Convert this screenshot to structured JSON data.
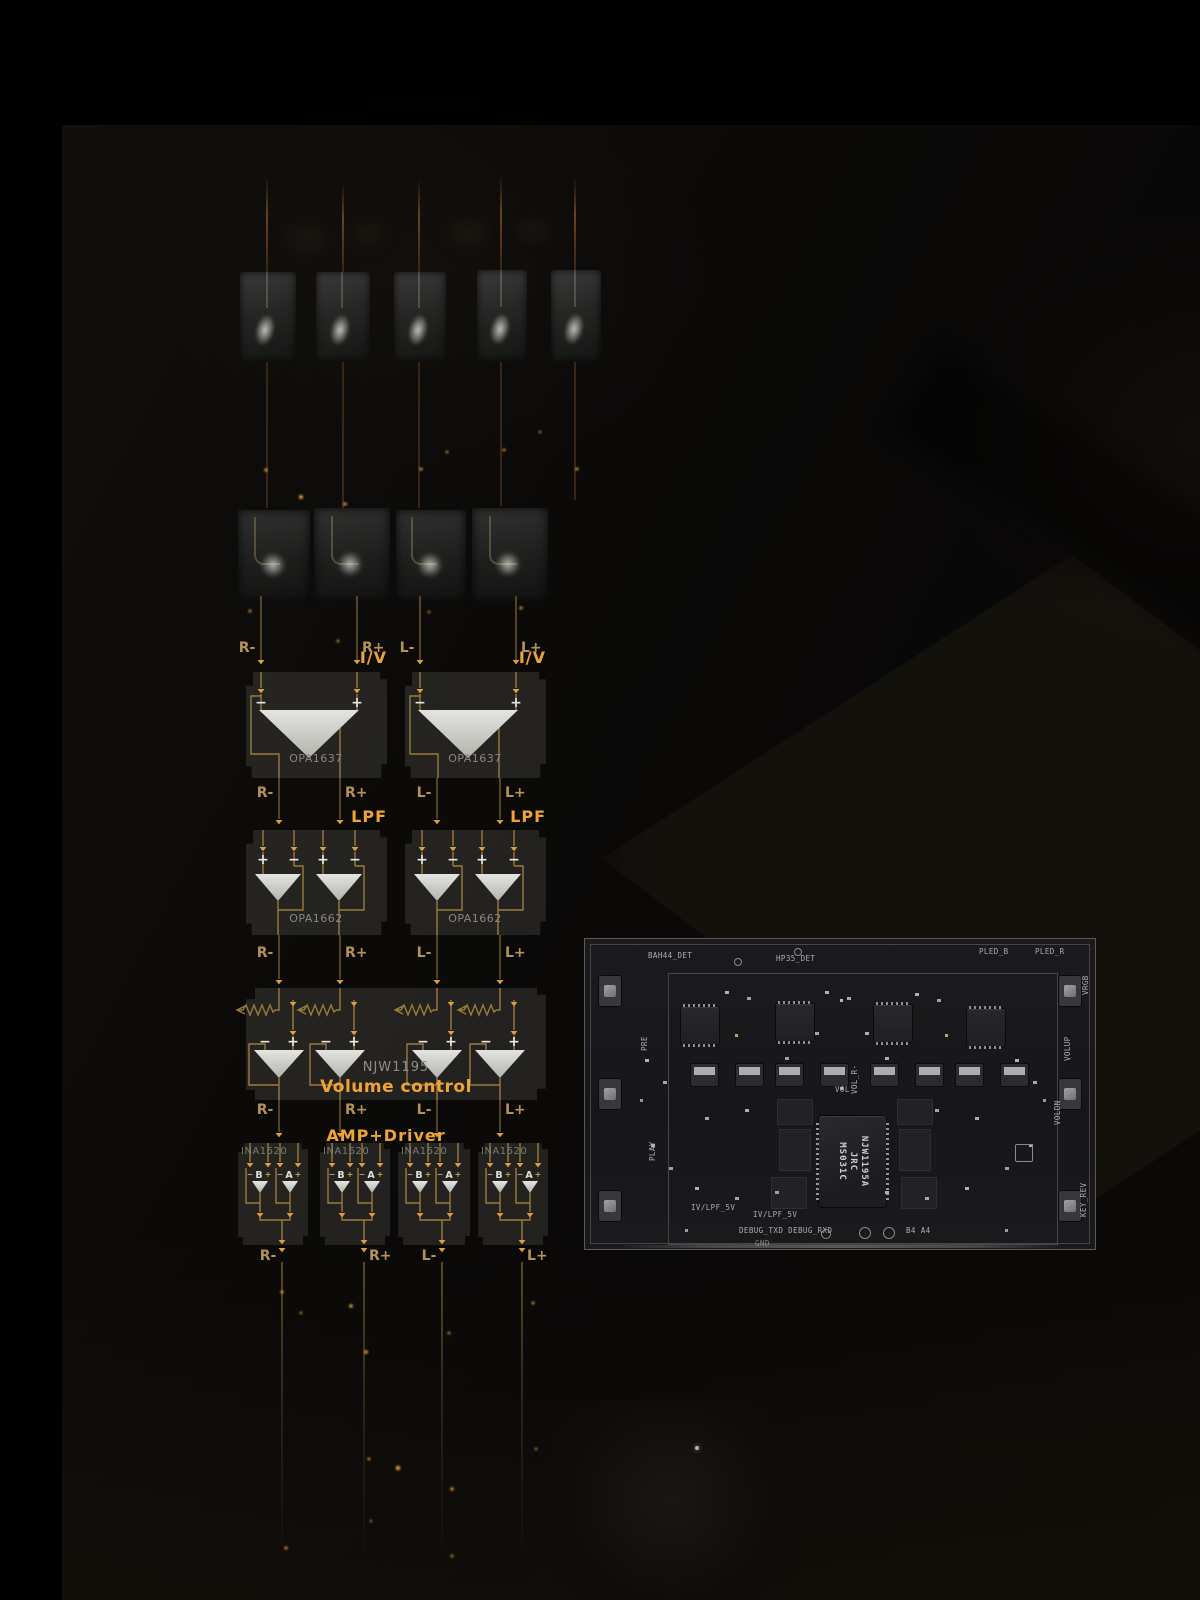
{
  "colors": {
    "accent": "#f0a435",
    "trace": "#9c7b3c",
    "arrow": "#dfa13f",
    "signal_label": "#b49258",
    "chip_text": "#8a8780",
    "opamp_fill": "#d9d9d4",
    "silkscreen": "#aeaeb2"
  },
  "signals": [
    "R-",
    "R+",
    "L-",
    "L+"
  ],
  "glyphs": {
    "minus": "−",
    "plus": "+"
  },
  "stages": {
    "iv": {
      "label": "I/V",
      "chip": "OPA1637"
    },
    "lpf": {
      "label": "LPF",
      "chip": "OPA1662"
    },
    "volume": {
      "chip": "NJW1195",
      "label": "Volume control"
    },
    "amp": {
      "label": "AMP+Driver",
      "chip": "INA1620",
      "channel_b": "B",
      "channel_a": "A"
    }
  },
  "pcb": {
    "top_labels": {
      "left": "BAH44_DET",
      "center": "HP35_DET",
      "right1": "PLED_B",
      "right2": "PLED_R"
    },
    "left_labels": {
      "pre": "PRE",
      "play": "PLAY"
    },
    "right_labels": {
      "vrgb": "VRGB",
      "volup": "VOLUP",
      "voldn": "VOLDN",
      "keyrev": "KEY_REV"
    },
    "center_labels": {
      "vol_r": "VOL_R-",
      "vol": "VOL"
    },
    "bottom_labels": {
      "ivlpf1": "IV/LPF_5V",
      "ivlpf2": "IV/LPF_5V",
      "debug": "DEBUG_TXD DEBUG_RXD",
      "b4a4": "B4 A4",
      "gnd": "GND"
    },
    "main_chip": {
      "line1": "NJW1195A",
      "line2": "JRC",
      "line3": "MS031C"
    }
  }
}
